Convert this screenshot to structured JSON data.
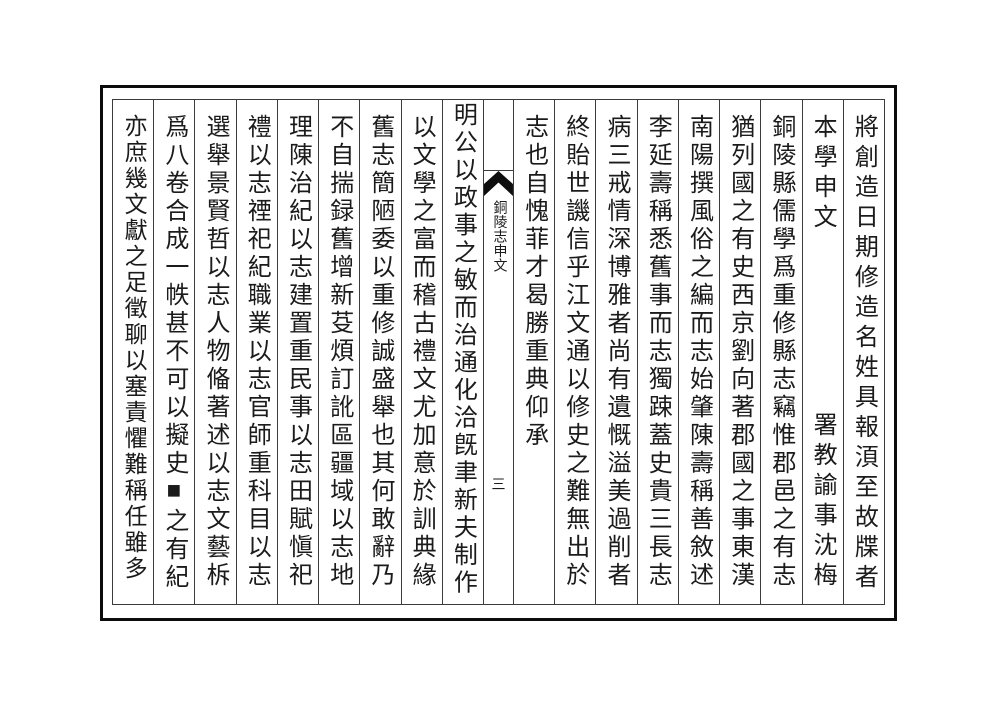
{
  "page": {
    "ink_color": "#1b1b1b",
    "border_color": "#0c0c0c",
    "fold": {
      "title": "銅陵志申文",
      "page_number": "三",
      "fishtail_icon": "fishtail-mark"
    },
    "columns": [
      {
        "text": "將創造日期修造名姓具報湏至故牒者"
      },
      {
        "top": "本學申文",
        "bottom": "署教諭事沈梅"
      },
      {
        "text": "銅陵縣儒學爲重修縣志竊惟郡邑之有志"
      },
      {
        "text": "猶列國之有史西京劉向著郡國之事東漢"
      },
      {
        "text": "南陽撰風俗之編而志始肇陳壽稱善敘述"
      },
      {
        "text": "李延壽稱悉舊事而志獨踈蓋史貴三長志"
      },
      {
        "text": "病三戒情深博雅者尚有遺慨溢美過削者"
      },
      {
        "text": "終貽世譏信乎江文通以修史之難無出於"
      },
      {
        "text": "志也自愧菲才曷勝重典仰承"
      },
      {
        "text": "明公以政事之敏而治通化洽旣聿新夫制作"
      },
      {
        "text": "以文學之富而稽古禮文尤加意於訓典緣"
      },
      {
        "text": "舊志簡陋委以重修誠盛舉也其何敢辭乃"
      },
      {
        "text": "不自揣録舊增新芟煩訂訛區疆域以志地"
      },
      {
        "text": "理陳治紀以志建置重民事以志田賦愼祀"
      },
      {
        "text": "禮以志禋祀紀職業以志官師重科目以志"
      },
      {
        "text": "選舉景賢哲以志人物偹著述以志文藝柝"
      },
      {
        "text": "爲八卷合成一帙甚不可以擬史■之有紀"
      },
      {
        "text": "亦庶幾文獻之足徵聊以塞責懼難稱任雖多"
      }
    ]
  }
}
